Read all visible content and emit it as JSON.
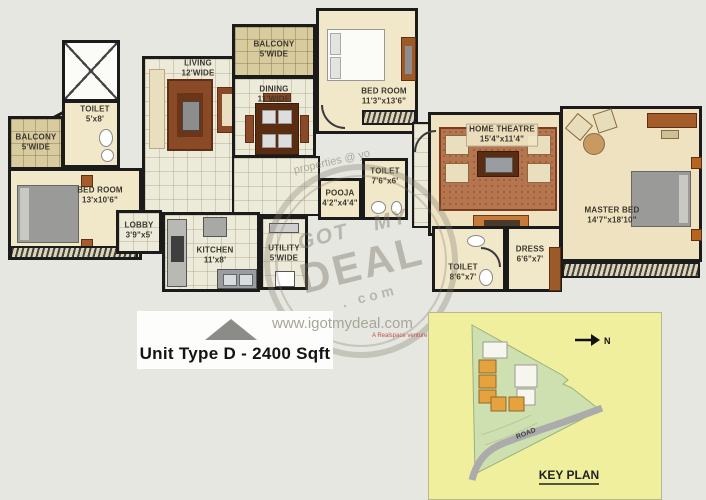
{
  "floor_plan": {
    "rooms": {
      "balcony_left": {
        "label": "BALCONY",
        "dim": "5'WIDE"
      },
      "toilet_left": {
        "label": "TOILET",
        "dim": "5'x8'"
      },
      "bed_left": {
        "label": "BED ROOM",
        "dim": "13'x10'6\""
      },
      "living": {
        "label": "LIVING",
        "dim": "12'WIDE"
      },
      "balcony_top": {
        "label": "BALCONY",
        "dim": "5'WIDE"
      },
      "dining": {
        "label": "DINING",
        "dim": "11'WIDE"
      },
      "bed_top": {
        "label": "BED ROOM",
        "dim": "11'3\"x13'6\""
      },
      "lobby": {
        "label": "LOBBY",
        "dim": "3'9\"x5'"
      },
      "kitchen": {
        "label": "KITCHEN",
        "dim": "11'x8'"
      },
      "utility": {
        "label": "UTILITY",
        "dim": "5'WIDE"
      },
      "pooja": {
        "label": "POOJA",
        "dim": "4'2\"x4'4\""
      },
      "toilet_mid": {
        "label": "TOILET",
        "dim": "7'6\"x6'"
      },
      "home_theatre": {
        "label": "HOME THEATRE",
        "dim": "15'4\"x11'4\""
      },
      "master_bed": {
        "label": "MASTER BED",
        "dim": "14'7\"x18'10\""
      },
      "toilet_master": {
        "label": "TOILET",
        "dim": "8'6\"x7'"
      },
      "dress": {
        "label": "DRESS",
        "dim": "6'6\"x7'"
      }
    }
  },
  "watermark": {
    "stamp_word1": "GOT",
    "stamp_word2": "MY",
    "stamp_word3": "DEAL",
    "stamp_word4": ". com",
    "diagonal_text": "properties @ yo"
  },
  "footer": {
    "unit_label": "Unit Type D - 2400 Sqft"
  },
  "website": {
    "url": "www.igotmydeal.com",
    "tagline": "A Realspace venture"
  },
  "key_plan": {
    "title": "KEY PLAN",
    "road_label": "ROAD",
    "north_label": "N"
  },
  "colors": {
    "wall": "#1b1b1b",
    "keyplan_bg": "#f0ef9e",
    "site_green": "#cfe0b0",
    "road_gray": "#ababab",
    "building_orange": "#e6a23c"
  }
}
